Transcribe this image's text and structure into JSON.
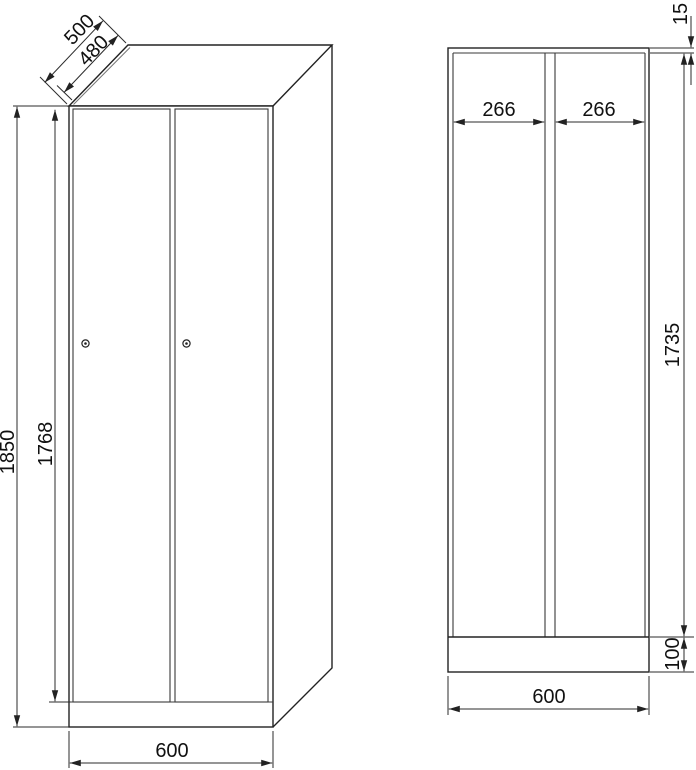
{
  "drawing": {
    "background": "#ffffff",
    "line_color": "#222222",
    "front_view": {
      "dim_depth_outer": "500",
      "dim_depth_inner": "480",
      "dim_height_total": "1850",
      "dim_door_height": "1768",
      "dim_width": "600"
    },
    "section_view": {
      "dim_top_panel_thickness": "15",
      "dim_left_compartment_width": "266",
      "dim_right_compartment_width": "266",
      "dim_interior_height": "1735",
      "dim_plinth_height": "100",
      "dim_width": "600"
    }
  }
}
